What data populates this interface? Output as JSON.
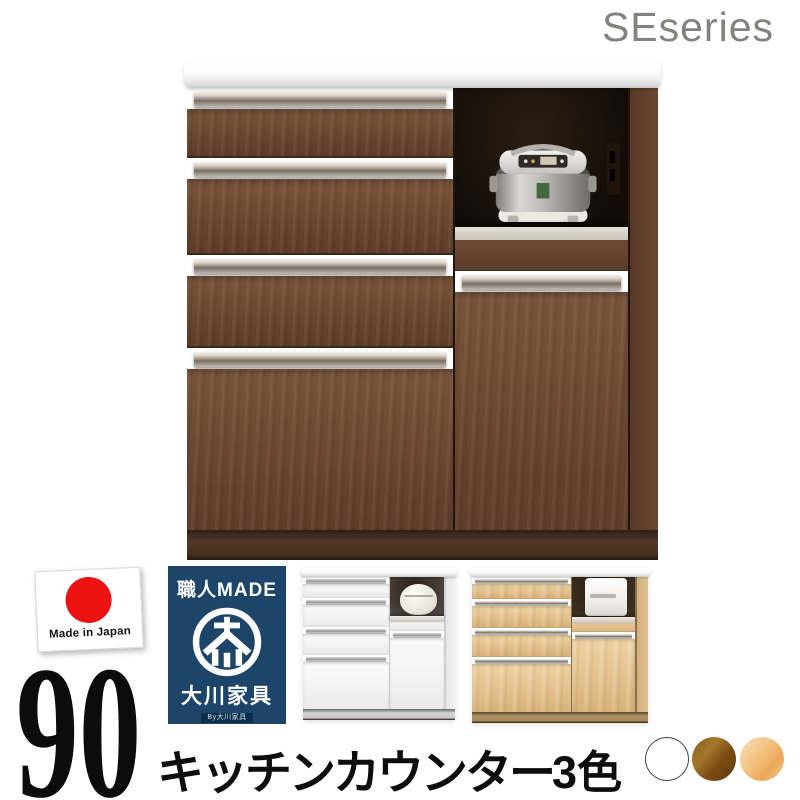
{
  "header": {
    "series_label": "SEseries"
  },
  "badges": {
    "made_in_japan": {
      "label": "Made in Japan"
    },
    "craftsman": {
      "top_label": "職人MADE",
      "brand_label": "大川家具",
      "sub_label": "By大川家具"
    }
  },
  "caption": {
    "size_label": "90",
    "product_label": "キッチンカウンター",
    "color_count_label": "3色"
  },
  "swatches": [
    {
      "name": "white",
      "hex": "#ffffff"
    },
    {
      "name": "brown",
      "hex": "#7c4d12"
    },
    {
      "name": "natural",
      "hex": "#f0bf7d"
    }
  ],
  "images": {
    "main_cabinet": "walnut-kitchen-counter-with-rice-cooker",
    "white_variant": "white-kitchen-counter-thumbnail",
    "natural_variant": "natural-kitchen-counter-thumbnail",
    "flag": "japan-flag",
    "logo": "okawa-kagu-circle-mark"
  }
}
